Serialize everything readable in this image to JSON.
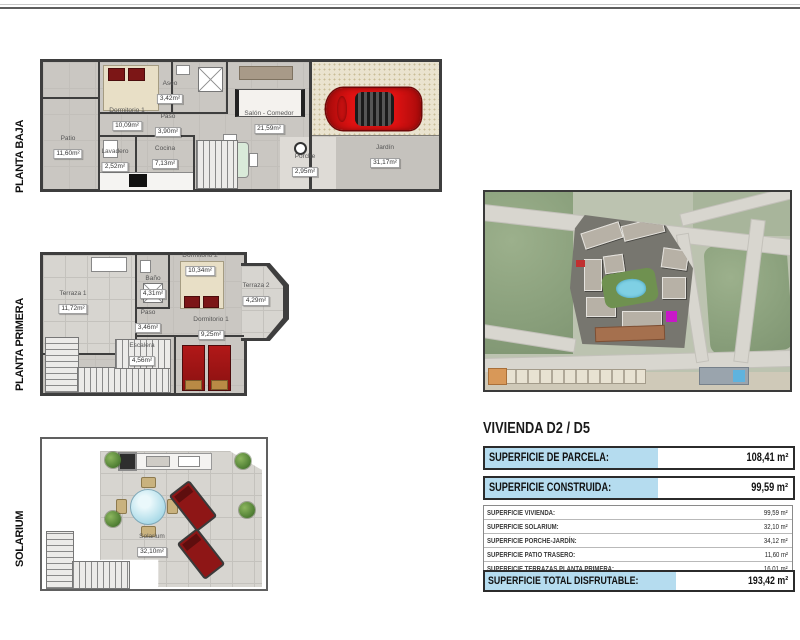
{
  "plans": [
    {
      "label": "PLANTA BAJA",
      "rooms": [
        {
          "name": "Dormitorio 1",
          "area": "10,09m²"
        },
        {
          "name": "Aseo",
          "area": "3,42m²"
        },
        {
          "name": "Paso",
          "area": "3,90m²"
        },
        {
          "name": "Salón - Comedor",
          "area": "21,59m²"
        },
        {
          "name": "Patio",
          "area": "11,60m²"
        },
        {
          "name": "Lavadero",
          "area": "2,52m²"
        },
        {
          "name": "Cocina",
          "area": "7,13m²"
        },
        {
          "name": "Porche",
          "area": "2,95m²"
        },
        {
          "name": "Jardín",
          "area": "31,17m²"
        }
      ]
    },
    {
      "label": "PLANTA PRIMERA",
      "rooms": [
        {
          "name": "Terraza 1",
          "area": "11,72m²"
        },
        {
          "name": "Baño",
          "area": "4,31m²"
        },
        {
          "name": "Dormitorio 2",
          "area": "10,34m²"
        },
        {
          "name": "Terraza 2",
          "area": "4,29m²"
        },
        {
          "name": "Paso",
          "area": "3,46m²"
        },
        {
          "name": "Escalera",
          "area": "4,56m²"
        },
        {
          "name": "Dormitorio 1",
          "area": "9,25m²"
        }
      ]
    },
    {
      "label": "SOLARIUM",
      "rooms": [
        {
          "name": "Solarium",
          "area": "32,10m²"
        }
      ]
    }
  ],
  "summary": {
    "title": "VIVIENDA D2 / D5",
    "parcela_label": "SUPERFICIE DE PARCELA:",
    "parcela_value": "108,41 m²",
    "construida_label": "SUPERFICIE CONSTRUIDA:",
    "construida_value": "99,59 m²",
    "detail_rows": [
      {
        "label": "SUPERFICIE VIVIENDA:",
        "value": "99,59 m²"
      },
      {
        "label": "SUPERFICIE SOLARIUM:",
        "value": "32,10 m²"
      },
      {
        "label": "SUPERFICIE PORCHE-JARDÍN:",
        "value": "34,12 m²"
      },
      {
        "label": "SUPERFICIE PATIO TRASERO:",
        "value": "11,60 m²"
      },
      {
        "label": "SUPERFICIE TERRAZAS PLANTA PRIMERA:",
        "value": "16,01 m²"
      }
    ],
    "total_label": "SUPERFICIE TOTAL DISFRUTABLE:",
    "total_value": "193,42 m²"
  },
  "colors": {
    "accent_blue": "#b5dcef",
    "floor_gray": "#cac7c2",
    "wall_dark": "#3e3e3e",
    "car_red": "#e01212",
    "bed_red": "#8a1111",
    "plant_green": "#4e7d33",
    "pool_blue": "#7fd0e4"
  }
}
